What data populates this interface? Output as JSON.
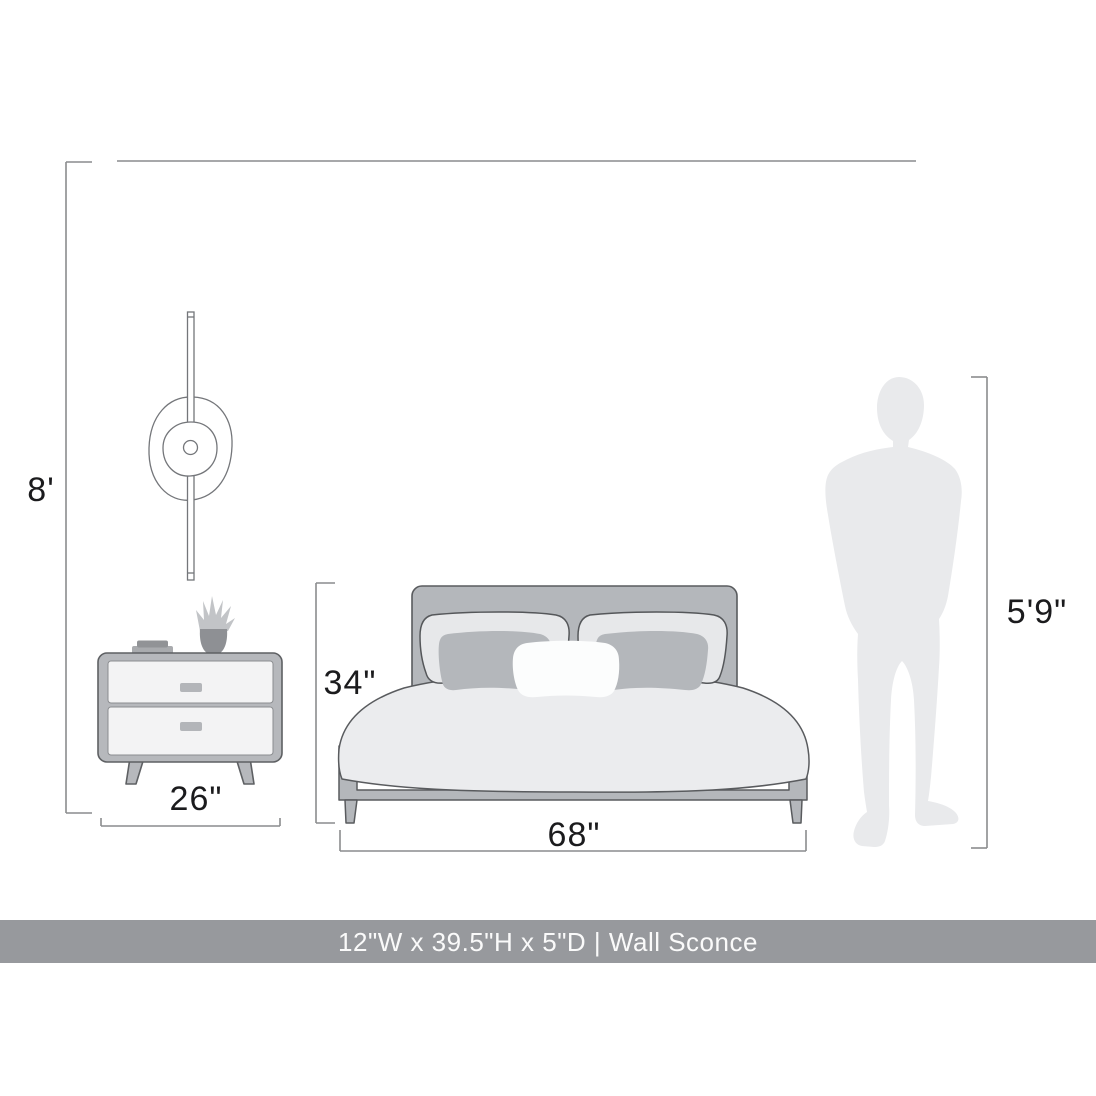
{
  "diagram": {
    "labels": {
      "wall_height": "8'",
      "nightstand_width": "26\"",
      "bed_height": "34\"",
      "bed_width": "68\"",
      "person_height": "5'9\""
    },
    "objects": {
      "sconce": "wall-sconce-illustration",
      "nightstand": "nightstand-illustration",
      "bed": "bed-illustration",
      "person": "person-silhouette"
    },
    "colors": {
      "dimension_line": "#8a8c8e",
      "furniture_outline": "#595b5e",
      "furniture_gray": "#b6b8bc",
      "drawer_light": "#f3f3f4",
      "duvet_light": "#ebecee",
      "silhouette_gray": "#e9eaec",
      "label_text": "#1b1b1d"
    }
  },
  "footer": {
    "text": "12\"W x 39.5\"H x 5\"D | Wall Sconce",
    "background": "#97999d",
    "text_color": "#fafafa"
  }
}
